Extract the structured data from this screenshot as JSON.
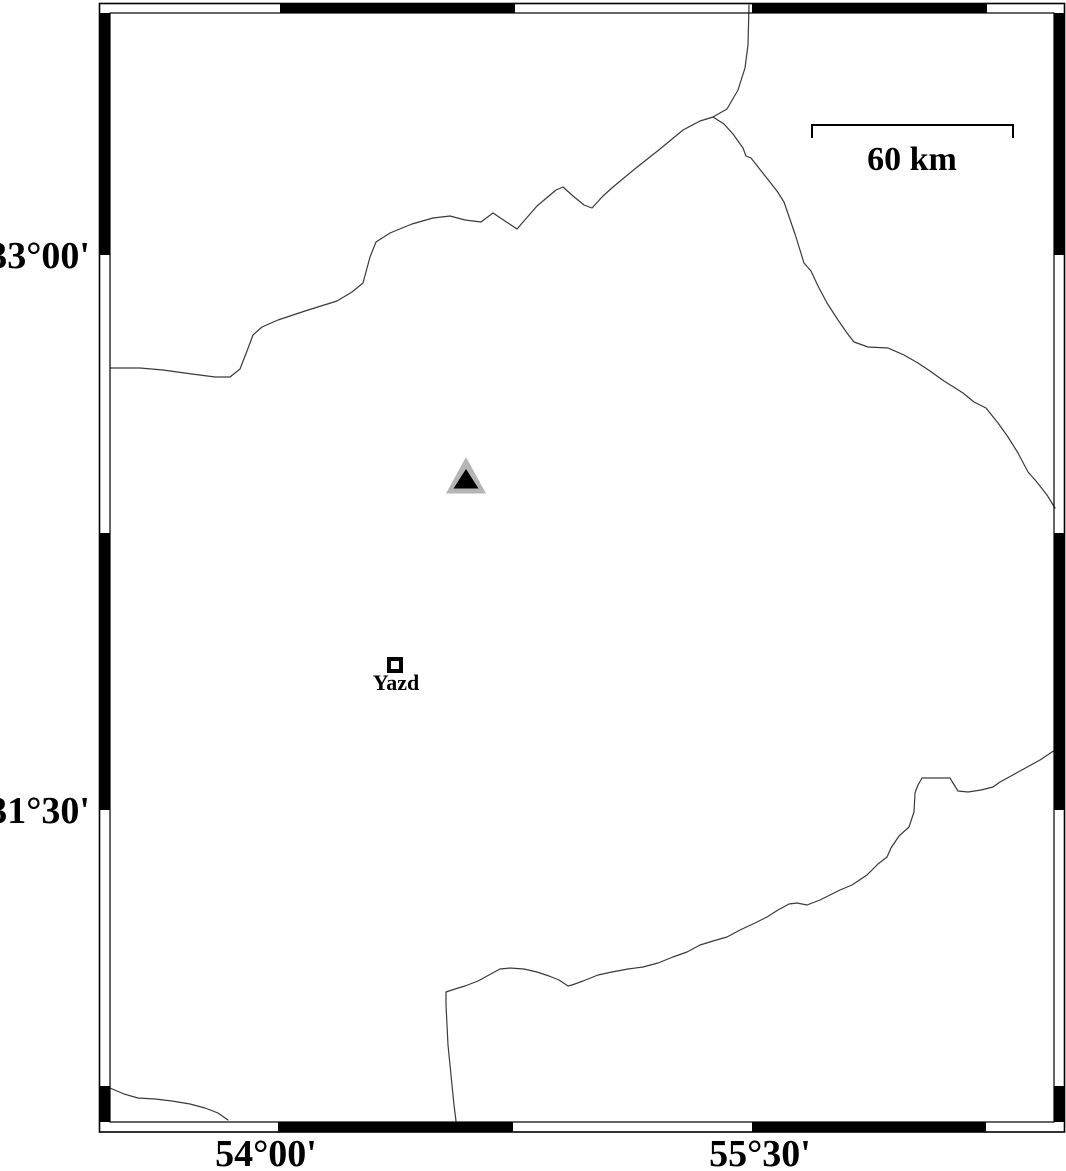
{
  "map": {
    "region_name": "Yazd area map",
    "axis_labels": {
      "latitude": [
        {
          "text": "33°00'",
          "x": 90,
          "y": 268
        },
        {
          "text": "31°30'",
          "x": 90,
          "y": 823
        }
      ],
      "longitude": [
        {
          "text": "54°00'",
          "x": 266,
          "y": 1166
        },
        {
          "text": "55°30'",
          "x": 760,
          "y": 1166
        }
      ]
    },
    "frame": {
      "outer_rect": {
        "x": 99.5,
        "y": 3.5,
        "w": 965,
        "h": 1128.5
      },
      "inner_rect": {
        "x": 110,
        "y": 13,
        "w": 944,
        "h": 1109
      },
      "segments": [
        {
          "x": 280,
          "y": 3.5,
          "w": 235,
          "h": 9.5
        },
        {
          "x": 752,
          "y": 3.5,
          "w": 235,
          "h": 9.5
        },
        {
          "x": 278,
          "y": 1122,
          "w": 235,
          "h": 10
        },
        {
          "x": 752,
          "y": 1122,
          "w": 234,
          "h": 10
        },
        {
          "x": 99.5,
          "y": 13,
          "w": 10.5,
          "h": 242
        },
        {
          "x": 99.5,
          "y": 533,
          "w": 10.5,
          "h": 277
        },
        {
          "x": 99.5,
          "y": 1086,
          "w": 10.5,
          "h": 36
        },
        {
          "x": 1054,
          "y": 13,
          "w": 10.5,
          "h": 242
        },
        {
          "x": 1054,
          "y": 533,
          "w": 10.5,
          "h": 277
        },
        {
          "x": 1054,
          "y": 1086,
          "w": 10.5,
          "h": 36
        }
      ]
    },
    "scale_bar": {
      "label": "60 km",
      "label_x": 912,
      "label_y": 170,
      "path": "M 812,138 L 812,125 L 1013,125 L 1013,138"
    },
    "markers": {
      "triangle": {
        "outer_points": "466,457 446,493.5 486,493.5",
        "inner_points": "466,469 453.5,488.5 478.5,488.5"
      },
      "city": {
        "label": "Yazd",
        "label_x": 396,
        "label_y": 690,
        "square": {
          "x": 389,
          "y": 659,
          "w": 12,
          "h": 12
        }
      }
    },
    "boundaries": {
      "north_main": {
        "path": "M 110,368 L 140,368 L 163,370 L 192,374 L 215,377 L 230,377 L 240,369 L 247,351 L 253,335 L 262,327 L 278,320 L 305,311 L 337,301 L 352,292 L 363,283 L 370,257 L 376,242 L 390,233 L 412,224 L 433,218 L 450,216 L 465,220 L 481,222 L 493,213 L 505,221 L 517,229 L 537,206 L 556,190 L 563,187 L 573,196 L 584,205 L 592,208 L 603,196 L 613,187 L 636,168 L 660,149 L 683,130 L 700,121 L 713,117 L 727,109 L 738,90 L 745,68 L 748,45 L 749,5"
      },
      "northeast_branch": {
        "path": "M 713,117 L 724,124 L 733,134 L 743,148 L 746,156 L 751,158 L 762,172 L 777,191 L 784,202 L 795,234 L 804,263 L 811,271 L 818,286 L 827,303 L 838,320 L 847,333 L 854,342 L 868,347 L 888,348 L 904,355 L 918,363 L 930,371 L 944,381 L 963,393 L 974,402 L 986,408 L 998,423 L 1008,437 L 1018,453 L 1028,472 L 1036,481 L 1047,495 L 1055,508"
      },
      "south_main": {
        "path": "M 1055,750 L 1040,760 L 1020,771 L 1000,782 L 993,787 L 981,790 L 968,792 L 958,791 L 953,783 L 950,778 L 936,778 L 922,778 L 918,785 L 915,793 L 914,812 L 909,827 L 899,836 L 891,848 L 887,857 L 878,864 L 867,875 L 852,885 L 840,890 L 832,894 L 820,900 L 807,905 L 797,903 L 789,904 L 778,910 L 767,917 L 755,923 L 740,930 L 727,937 L 713,941 L 700,945 L 687,952 L 673,957 L 658,963 L 643,967 L 628,969 L 612,972 L 598,975 L 583,981 L 572,985 L 568,986 L 559,980 L 549,976 L 537,972 L 524,969 L 510,968 L 500,969 L 489,975 L 478,981 L 465,986 L 455,989 L 446,992 L 446,1005 L 447,1025 L 448,1045 L 450,1065 L 452,1085 L 454,1105 L 456,1121"
      },
      "southwest_short": {
        "path": "M 110,1088 L 124,1094 L 138,1098 L 155,1099 L 172,1101 L 190,1104 L 205,1108 L 218,1113 L 228,1120"
      }
    }
  },
  "colors": {
    "frame": "#000000",
    "boundary_line": "#3a3a3a",
    "triangle_outer": "#b5b5b5",
    "triangle_inner": "#000000",
    "background": "#ffffff"
  }
}
